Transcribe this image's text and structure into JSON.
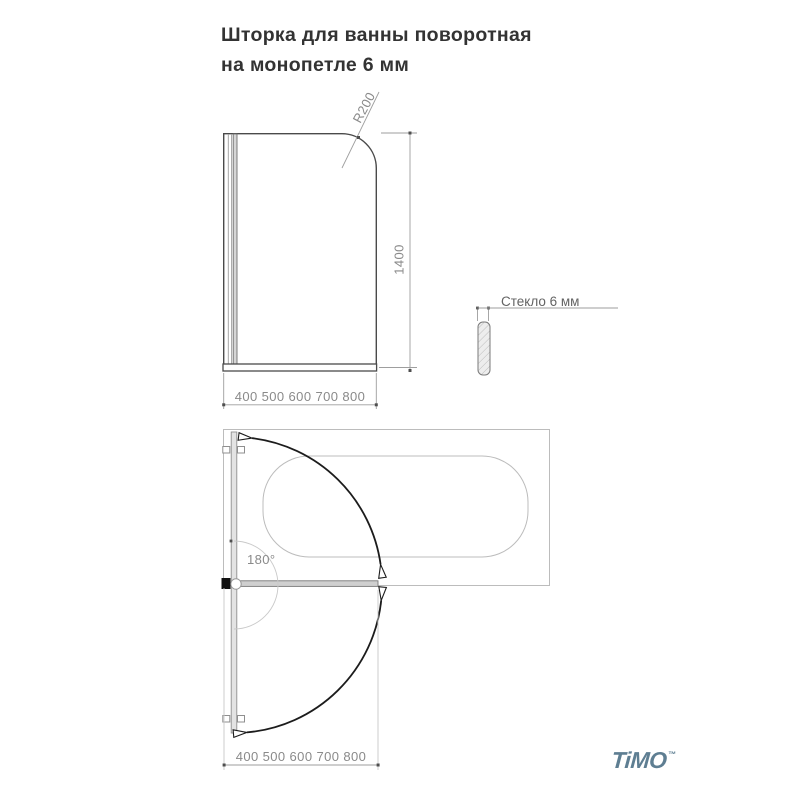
{
  "title": {
    "line1": "Шторка для ванны поворотная",
    "line2": "на монопетле 6 мм"
  },
  "front_view": {
    "radius_label": "R200",
    "height_label": "1400",
    "widths_label": "400 500 600 700 800"
  },
  "side_view": {
    "glass_label": "Стекло 6 мм"
  },
  "top_view": {
    "swing_angle_label": "180°",
    "widths_label": "400 500 600 700 800"
  },
  "branding": {
    "logo_text": "TiMO",
    "trademark": "™"
  },
  "colors": {
    "line_dark": "#4a4a4a",
    "line_grey": "#9e9e9e",
    "line_light": "#bcbcbc",
    "arc_black": "#1c1c1c",
    "dim_text": "#8a8a8a",
    "title_text": "#333333",
    "label_text": "#636363",
    "logo_color": "#5e7e92",
    "strip_fill": "#d6d6d6",
    "glass_fill": "#ededed"
  }
}
